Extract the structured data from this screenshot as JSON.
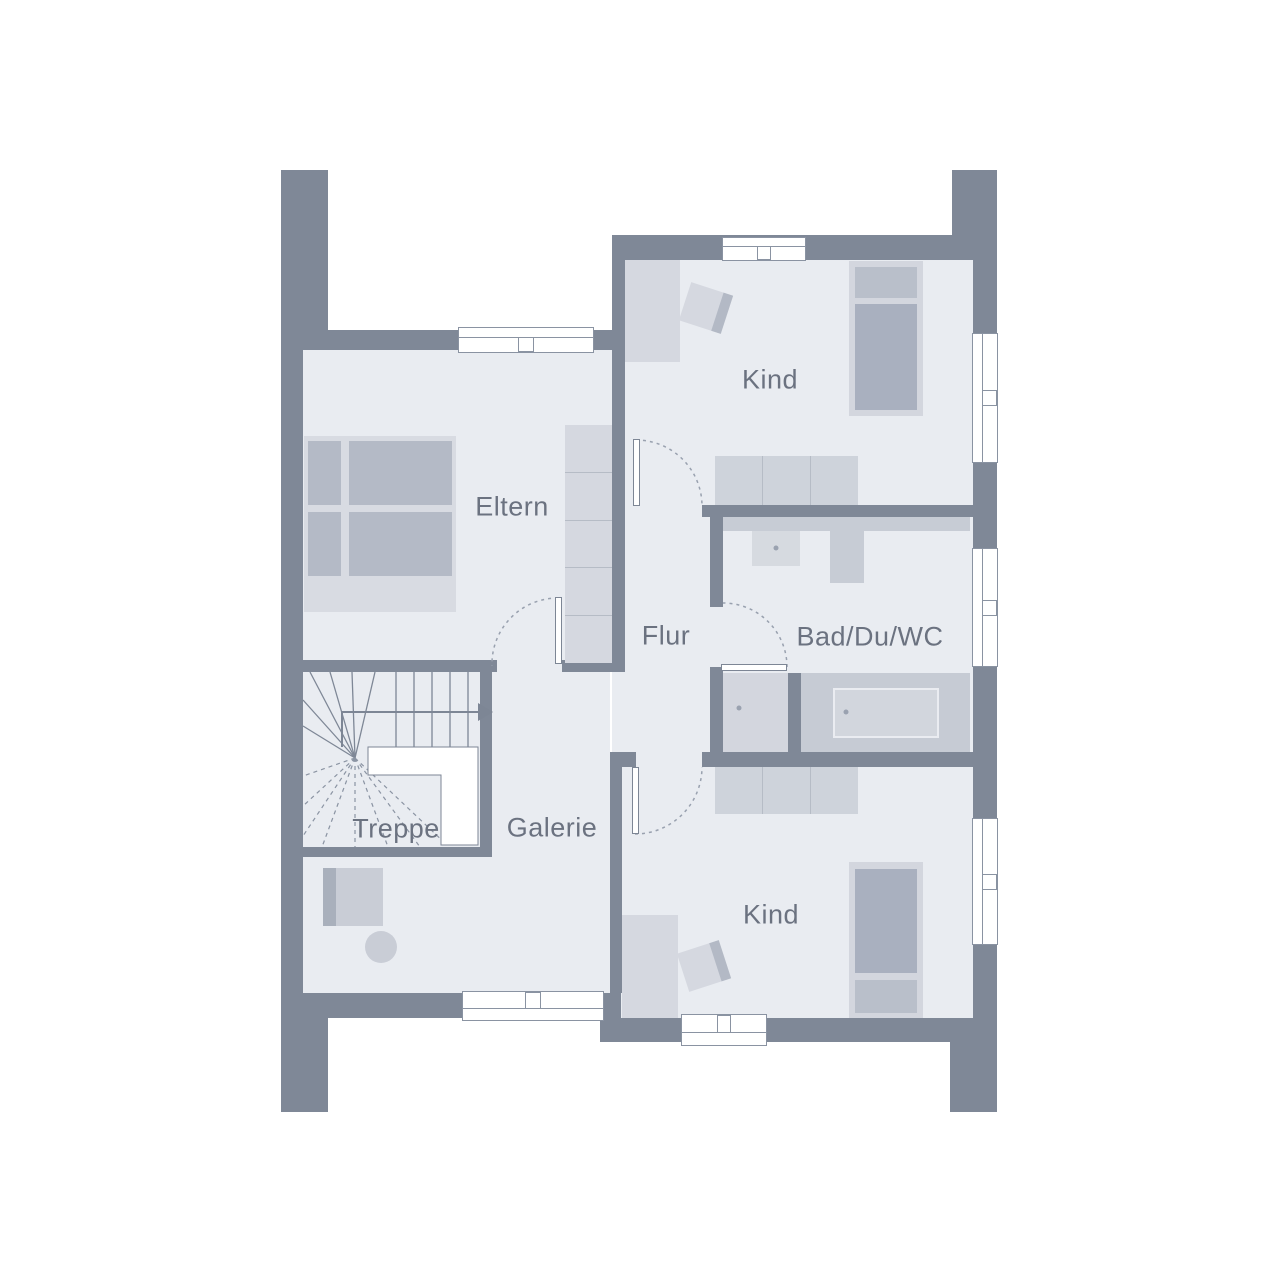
{
  "title": "Obergeschoss Grundriss",
  "rooms": [
    {
      "id": "kind-top",
      "label": "Kind"
    },
    {
      "id": "eltern",
      "label": "Eltern"
    },
    {
      "id": "flur",
      "label": "Flur"
    },
    {
      "id": "bad",
      "label": "Bad/Du/WC"
    },
    {
      "id": "treppe",
      "label": "Treppe"
    },
    {
      "id": "galerie",
      "label": "Galerie"
    },
    {
      "id": "kind-bottom",
      "label": "Kind"
    }
  ],
  "colors": {
    "wall": "#7f8897",
    "floor": "#e9ecf1",
    "furniture_light": "#d5d8e0",
    "furniture_mid": "#c7ccd5",
    "furniture_dark": "#a9b0bf",
    "outline": "#8a93a2",
    "text": "#6b7280",
    "background": "#ffffff"
  },
  "symbols": [
    "window",
    "door-swing",
    "winder-staircase",
    "walking-line-arrow",
    "double-bed",
    "single-bed",
    "wardrobe",
    "sideboard",
    "desk-chair",
    "washbasin",
    "wc",
    "shower",
    "bathtub",
    "armchair",
    "side-table"
  ]
}
